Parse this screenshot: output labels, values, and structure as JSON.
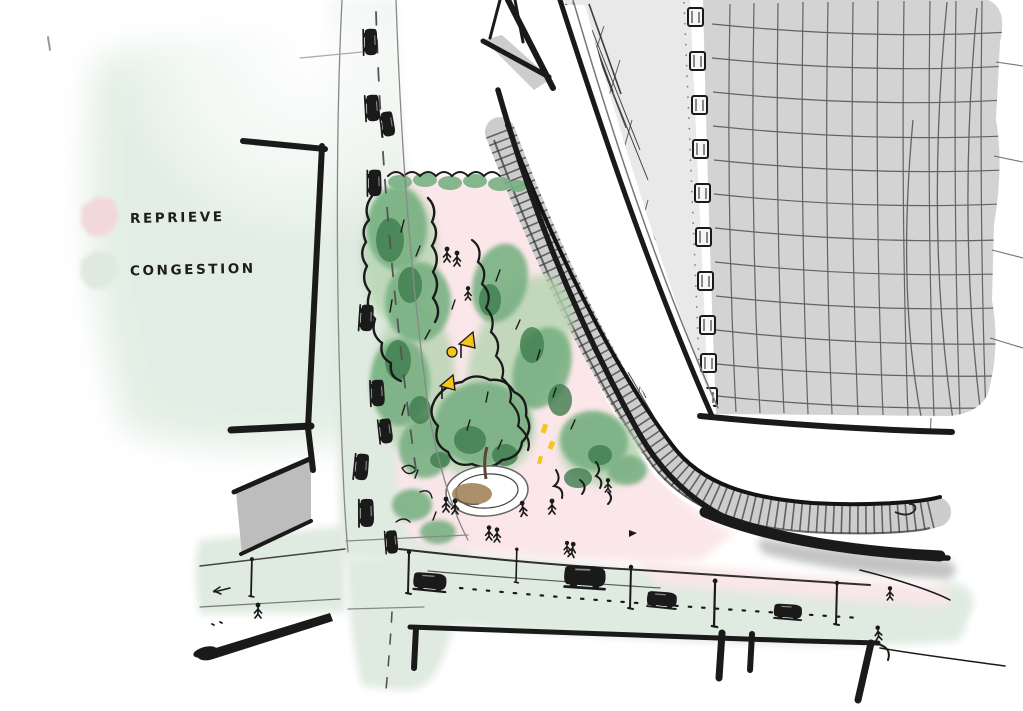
{
  "scene": {
    "alt": "Hand-drawn aerial sketch of a city corner: a pink triangular park full of trees, a round tree planter and pedestrians (reprieve) sits between green-tinted streets jammed with cars and lampposts (congestion), alongside a diagonal avenue with a hatched median wall and a tall cross-hatched tower at the top right."
  },
  "legend": {
    "items": [
      {
        "id": "reprieve",
        "label": "REPRIEVE",
        "color": "#f3d8da"
      },
      {
        "id": "congestion",
        "label": "CONGESTION",
        "color": "#dfeadf"
      }
    ]
  },
  "palette": {
    "ink": "#1a1a1a",
    "park_pink": "#fbe6e9",
    "street_green": "#dfeae0",
    "wash_green": "#dcebdf",
    "tree_light": "#b5d4b0",
    "tree_mid": "#79b183",
    "tree_dark": "#3f7d4e",
    "planter_soil": "#9d7b51",
    "accent_yellow": "#f5c51b",
    "building_light": "#e9e9e9",
    "building_dark": "#d3d3d3",
    "shadow_gray": "#bdbdbd",
    "hatch_gray": "#cdcdcd"
  },
  "icons": {
    "person": "stick figure pedestrian",
    "car": "black ink car blob",
    "lamppost": "pole with round head",
    "window": "framed square window",
    "tree": "scribbled green canopy"
  }
}
